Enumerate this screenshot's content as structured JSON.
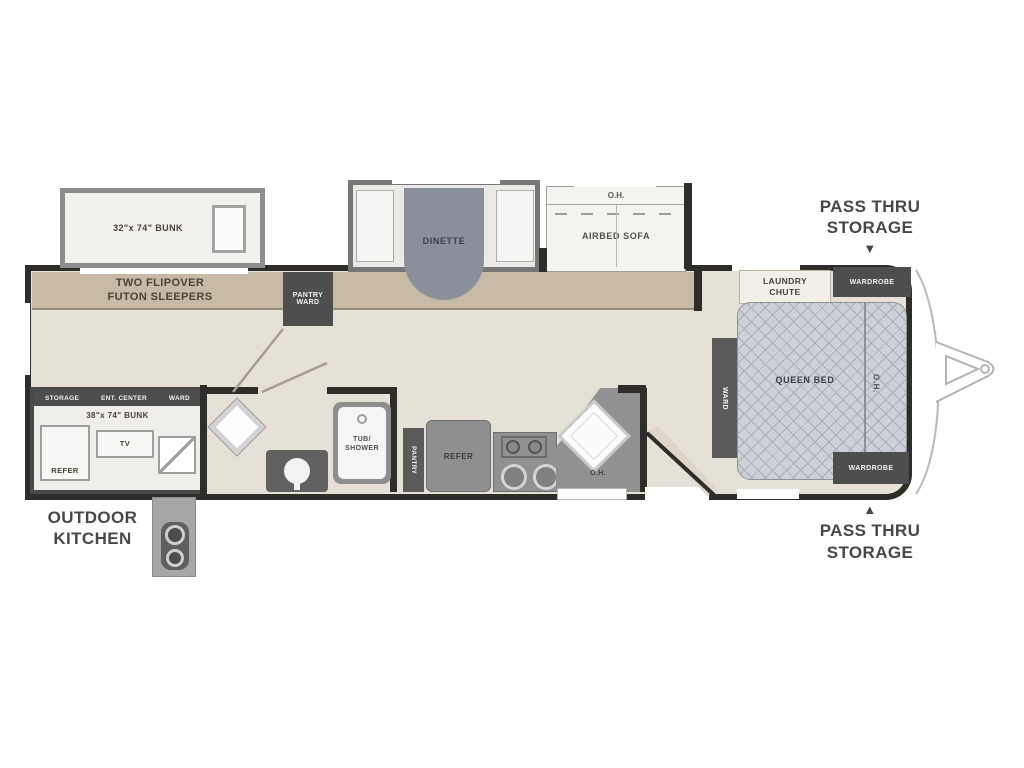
{
  "colors": {
    "floor": "#e6e1d6",
    "band": "#c6baa5",
    "wall": "#2f2d2a",
    "dark_box": "#4e4e4e",
    "bed_fill": "#cdd1d7",
    "counter": "#919191",
    "label_text": "#4a4336"
  },
  "exterior": {
    "pass_thru_top": {
      "line1": "PASS THRU",
      "line2": "STORAGE",
      "arrow": "▼"
    },
    "pass_thru_bottom": {
      "line1": "PASS THRU",
      "line2": "STORAGE",
      "arrow": "▲"
    },
    "outdoor_kitchen": {
      "line1": "OUTDOOR",
      "line2": "KITCHEN"
    }
  },
  "slides": {
    "bunk": {
      "label": "32\"x 74\" BUNK"
    },
    "dinette": {
      "label": "DINETTE"
    },
    "airbed": {
      "oh": "O.H.",
      "label": "AIRBED SOFA"
    }
  },
  "living": {
    "futon_line1": "TWO FLIPOVER",
    "futon_line2": "FUTON SLEEPERS",
    "pantry_line1": "PANTRY",
    "pantry_line2": "WARD"
  },
  "bath": {
    "tub_line1": "TUB/",
    "tub_line2": "SHOWER"
  },
  "kitchen": {
    "pantry": "PANTRY",
    "refer": "REFER",
    "oh": "O.H."
  },
  "bunkhouse": {
    "storage": "STORAGE",
    "ent_center": "ENT. CENTER",
    "ward": "WARD",
    "bunk": "38\"x 74\" BUNK",
    "refer": "REFER",
    "tv": "TV"
  },
  "bedroom": {
    "laundry_line1": "LAUNDRY",
    "laundry_line2": "CHUTE",
    "wardrobe_top": "WARDROBE",
    "wardrobe_bottom": "WARDROBE",
    "queen": "QUEEN BED",
    "oh": "O.H.",
    "ward": "WARD"
  }
}
